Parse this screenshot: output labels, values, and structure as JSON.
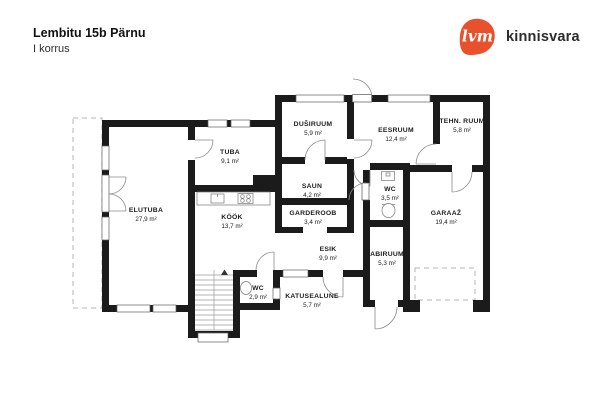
{
  "header": {
    "title": "Lembitu 15b Pärnu",
    "subtitle": "I korrus"
  },
  "logo": {
    "mark": "lvm",
    "name": "kinnisvara",
    "brand_color": "#e8512c",
    "text_color": "#2d2d2d"
  },
  "floor_plan": {
    "wall_color": "#1b1b1b",
    "rooms": [
      {
        "name": "ELUTUBA",
        "area": "27,9 m²"
      },
      {
        "name": "TUBA",
        "area": "9,1 m²"
      },
      {
        "name": "KÖÖK",
        "area": "13,7 m²"
      },
      {
        "name": "DUŠIRUUM",
        "area": "5,9 m²"
      },
      {
        "name": "SAUN",
        "area": "4,2 m²"
      },
      {
        "name": "GARDEROOB",
        "area": "3,4 m²"
      },
      {
        "name": "EESRUUM",
        "area": "12,4 m²"
      },
      {
        "name": "TEHN. RUUM",
        "area": "5,8 m²"
      },
      {
        "name": "WC",
        "area": "3,5 m²"
      },
      {
        "name": "GARAAŽ",
        "area": "19,4 m²"
      },
      {
        "name": "ESIK",
        "area": "9,9 m²"
      },
      {
        "name": "ABIRUUM",
        "area": "5,3 m²"
      },
      {
        "name": "WC",
        "area": "2,9 m²"
      },
      {
        "name": "KATUSEALUNE",
        "area": "5,7 m²"
      }
    ]
  }
}
